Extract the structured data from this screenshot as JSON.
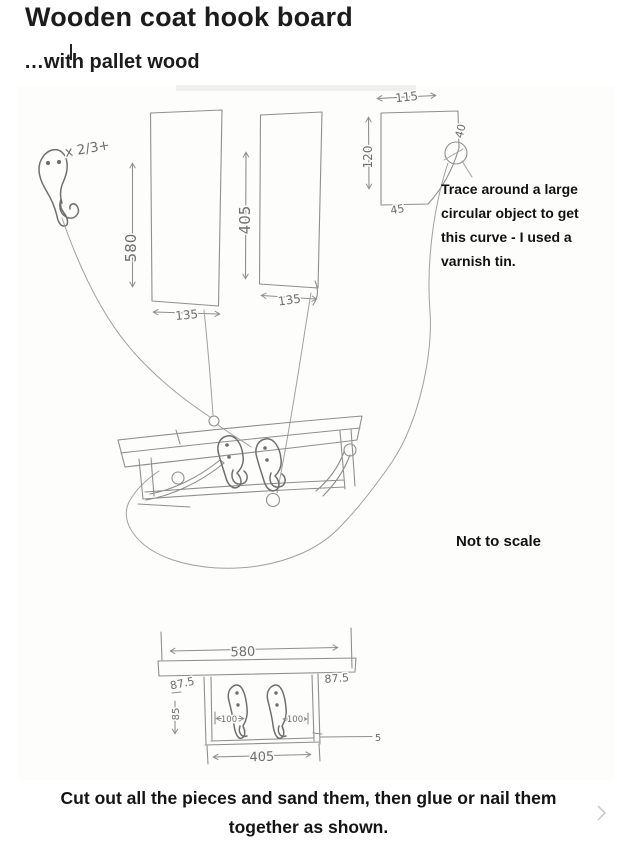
{
  "page": {
    "title": "Wooden coat hook board",
    "subtitle": "…with pallet wood"
  },
  "annotations": {
    "trace_note_lines": [
      "Trace around a large",
      "circular object to get",
      "this curve - I used a",
      "varnish tin."
    ],
    "scale_note": "Not to scale",
    "caption_line1": "Cut out all the pieces and sand them, then glue or nail them",
    "caption_line2": "together as shown."
  },
  "sketch": {
    "hook_label": "x 2/3+",
    "pencil_color": "#8f8f8f",
    "paper_color": "#fdfdfc",
    "dims": {
      "plank1_length": "580",
      "plank1_width": "135",
      "plank2_length": "405",
      "plank2_width": "135",
      "bracket_width": "115",
      "bracket_height": "120",
      "bracket_right": "40",
      "bracket_notch": "45",
      "front_width": "580",
      "overhang_left": "87.5",
      "overhang_right": "87.5",
      "side_height": "85",
      "hook_offset_left": "100",
      "hook_offset_right": "100",
      "back_width": "405",
      "step": "5"
    }
  }
}
